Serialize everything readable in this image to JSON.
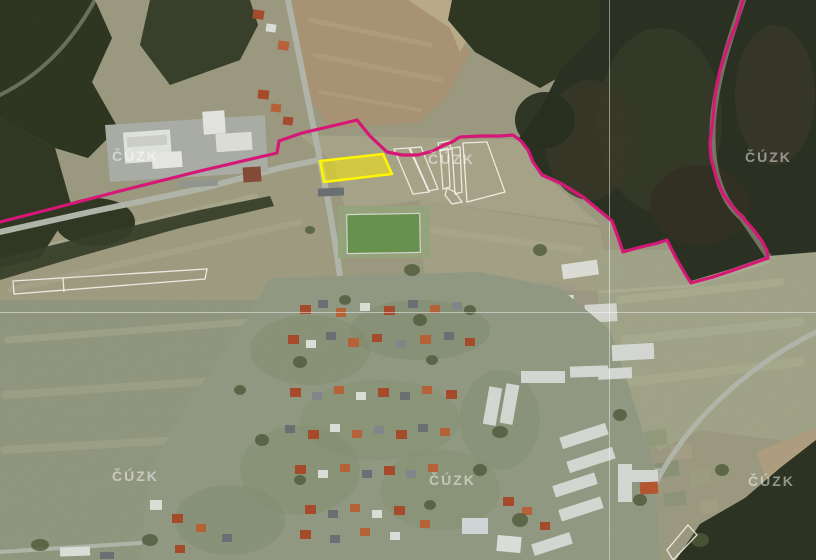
{
  "map": {
    "watermark": {
      "text": "ČÚZK"
    },
    "overlay_colors": {
      "cadastre_boundary": "#d61777",
      "selected_parcel_stroke": "#fff600",
      "selected_parcel_fill": "rgba(255,238,0,0.5)",
      "parcel_outline": "#f5f2ea",
      "map_sheet_grid": "#ffffff"
    }
  }
}
